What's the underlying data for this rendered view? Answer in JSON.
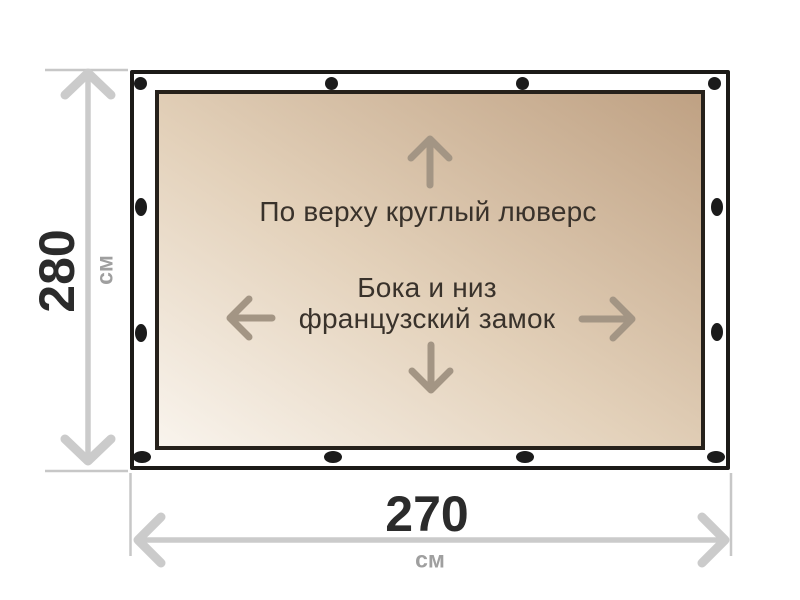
{
  "diagram": {
    "subject": "tarp-curtain-dimension-diagram"
  },
  "dimensions": {
    "height": {
      "value": "280",
      "unit": "см"
    },
    "width": {
      "value": "270",
      "unit": "см"
    }
  },
  "annotations": {
    "top_edge": "По верху круглый люверс",
    "sides_line1": "Бока и низ",
    "sides_line2": "французский замок"
  },
  "icons": {
    "grommet": "round-grommet",
    "direction_arrows": [
      "up-arrow",
      "down-arrow",
      "left-arrow",
      "right-arrow"
    ],
    "dimension_arrows": [
      "height-double-arrow",
      "width-double-arrow"
    ]
  },
  "colors": {
    "fabric_light": "#f9f4ed",
    "fabric_dark": "#bfa183",
    "outline": "#1c1a17",
    "grommet": "#1b1b1b",
    "dimension_gray": "#cbcbcb",
    "annotation_text": "#39322b",
    "dimension_number": "#2b2b2b",
    "unit_text": "#9f9f9f",
    "inner_arrow": "#a39584"
  }
}
